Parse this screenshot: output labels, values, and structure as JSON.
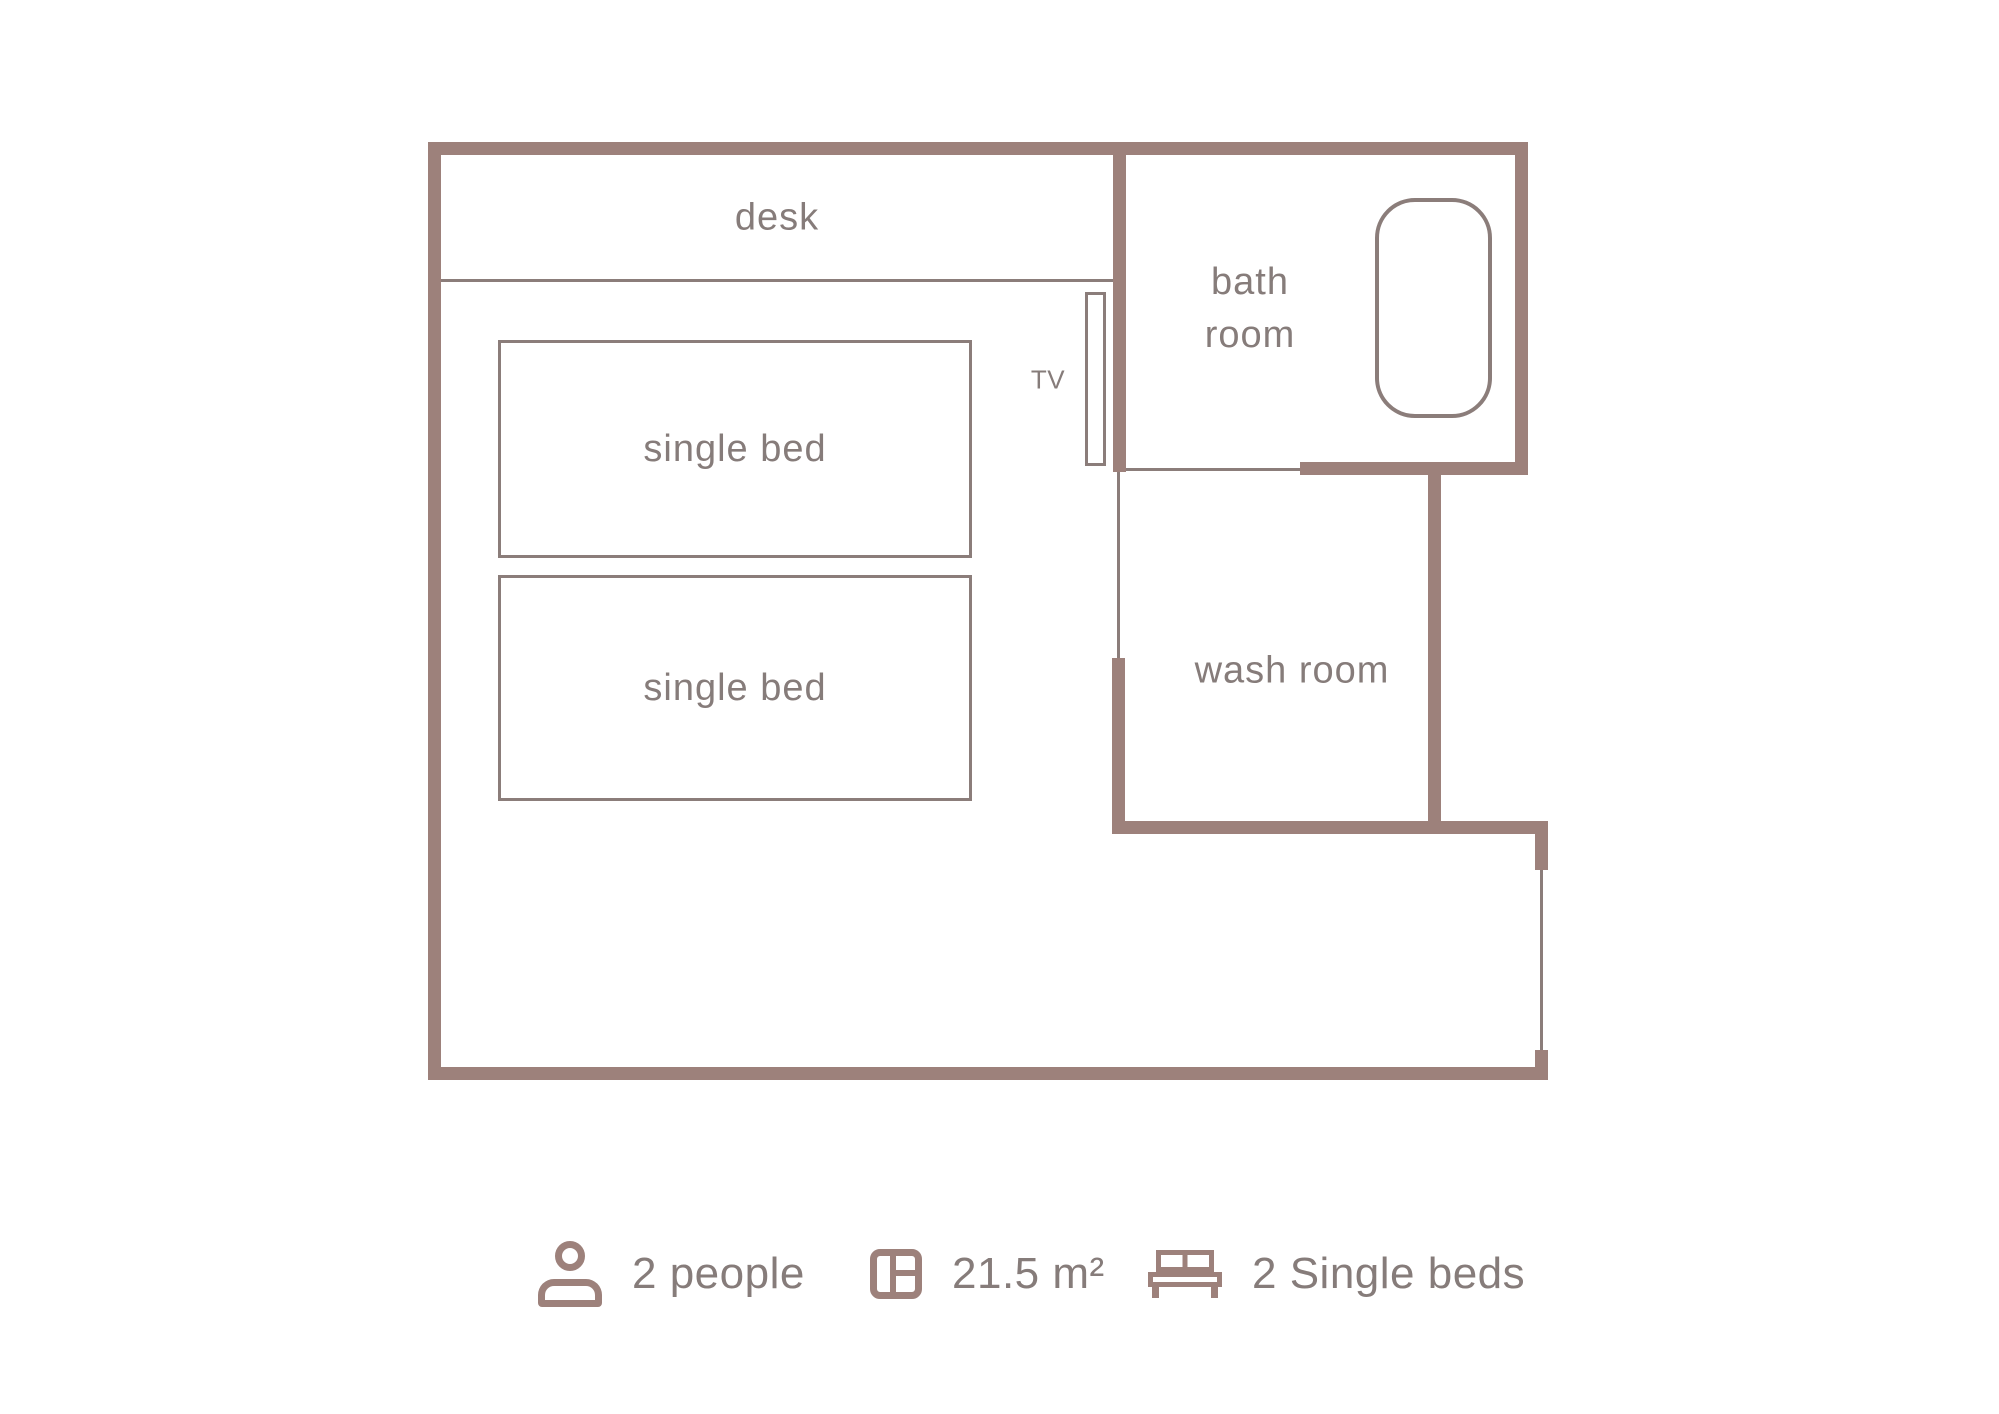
{
  "colors": {
    "wall": "#9d817b",
    "line": "#8b7d7a",
    "text": "#867c7a",
    "background": "#ffffff"
  },
  "plan": {
    "rooms": {
      "desk_label": "desk",
      "tv_label": "TV",
      "bed1_label": "single bed",
      "bed2_label": "single bed",
      "bathroom_label_line1": "bath",
      "bathroom_label_line2": "room",
      "washroom_label": "wash room"
    }
  },
  "legend": {
    "occupancy": {
      "icon": "person-icon",
      "label": "2 people"
    },
    "area": {
      "icon": "floor-area-icon",
      "label": "21.5 m²"
    },
    "beds": {
      "icon": "bed-icon",
      "label": "2 Single beds"
    }
  }
}
